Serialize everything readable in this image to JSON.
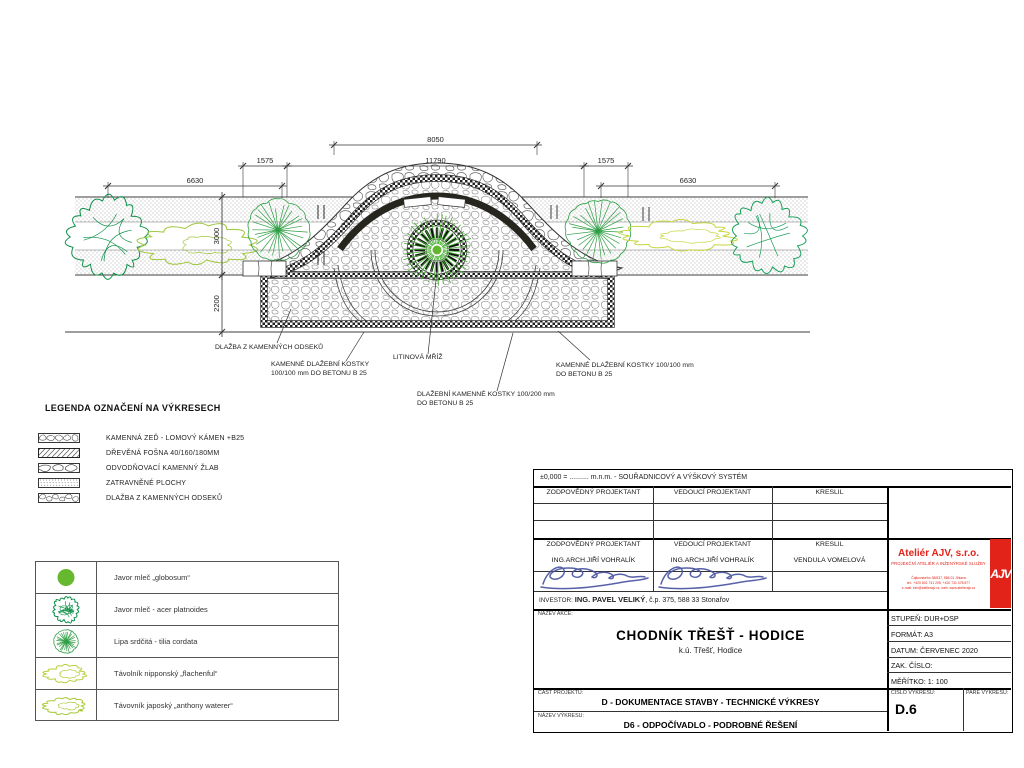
{
  "drawing": {
    "dims": {
      "d8050": "8050",
      "d11790": "11790",
      "d1575": "1575",
      "d6630": "6630",
      "d3000": "3000",
      "d2200": "2200"
    },
    "callouts": {
      "c1": {
        "l1": "DLAŽBA Z KAMENNÝCH ODSEKŮ"
      },
      "c2": {
        "l1": "KAMENNÉ DLAŽEBNÍ KOSTKY",
        "l2": "100/100 mm DO BETONU B 25"
      },
      "c3": {
        "l1": "LITINOVÁ MŘÍŽ"
      },
      "c4": {
        "l1": "DLAŽEBNÍ KAMENNÉ KOSTKY 100/200 mm",
        "l2": "DO BETONU B 25"
      },
      "c5": {
        "l1": "KAMENNÉ DLAŽEBNÍ KOSTKY 100/100 mm",
        "l2": "DO BETONU B 25"
      }
    }
  },
  "legend": {
    "title": "LEGENDA OZNAČENÍ NA VÝKRESECH",
    "items": [
      {
        "label": "KAMENNÁ ZEĎ - LOMOVÝ KÁMEN +B25",
        "swatch": "rubble-wall"
      },
      {
        "label": "DŘEVĚNÁ FOŠNA  40/160/180MM",
        "swatch": "diagonal-hatch"
      },
      {
        "label": "ODVODŇOVACÍ KAMENNÝ ŽLAB",
        "swatch": "stone-gutter"
      },
      {
        "label": "ZATRAVNĚNÉ PLOCHY",
        "swatch": "grass-stipple"
      },
      {
        "label": "DLAŽBA Z KAMENNÝCH ODSEKŮ",
        "swatch": "stone-paving"
      }
    ]
  },
  "plants": {
    "items": [
      {
        "label": "Javor mleč „globosum“",
        "symbol": "solid-green-circle"
      },
      {
        "label": "Javor mleč - acer platnoides",
        "symbol": "dark-green-crown"
      },
      {
        "label": "Lipa srdčitá - tilia cordata",
        "symbol": "radial-green-crown"
      },
      {
        "label": "Távolník nipponský „flachenful“",
        "symbol": "yellow-green-shrub"
      },
      {
        "label": "Távovník japoský „anthony waterer“",
        "symbol": "green-yellow-shrub"
      }
    ]
  },
  "title_block": {
    "datum_line": "±0,000 = ..........  m.n.m. - SOUŘADNICOVÝ A VÝŠKOVÝ SYSTÉM",
    "col_headers": {
      "h1": "ZODPOVĚDNÝ PROJEKTANT",
      "h2": "VEDOUCÍ PROJEKTANT",
      "h3": "KRESLIL"
    },
    "names": {
      "n1": "ING.ARCH.JIŘÍ VOHRALÍK",
      "n2": "ING.ARCH.JIŘÍ VOHRALÍK",
      "n3": "VENDULA VOMELOVÁ"
    },
    "investor_label": "INVESTOR:",
    "investor_value": "ING.   PAVEL VELIKÝ",
    "investor_suffix": ", č.p. 375, 588 33 Stonařov",
    "nazev_akce_label": "NÁZEV AKCE:",
    "project_title": "CHODNÍK TŘEŠŤ - HODICE",
    "project_subtitle": "k.ú. Třešť, Hodice",
    "company": {
      "name": "Ateliér AJV, s.r.o.",
      "tagline": "PROJEKČNÍ ATELIÉR A INŽENÝRSKÉ SLUŽBY",
      "line1": "Čajkovského 38/637, 586 01 Jihlava",
      "line2": "tel.: +420 602 741 205, +420 731 478 877",
      "line3": "e-mail: info@atelierajv.cz, web: www.atelierajv.cz",
      "logo": "AJV"
    },
    "fields": {
      "stupen_label": "STUPEŇ:",
      "stupen": "DUR+DSP",
      "format_label": "FORMÁT:",
      "format": "A3",
      "datum_label": "DATUM:",
      "datum": "ČERVENEC 2020",
      "zak_label": "ZAK. ČÍSLO:",
      "zak": "",
      "meritko_label": "MĚŘÍTKO:",
      "meritko": "1: 100"
    },
    "cast_label": "ČÁST PROJEKTU:",
    "cast_value": "D - DOKUMENTACE STAVBY - TECHNICKÉ VÝKRESY",
    "vykres_label": "NÁZEV VÝKRESU:",
    "vykres_value": "D6 - ODPOČÍVADLO - PODROBNÉ ŘEŠENÍ",
    "cislo_label": "ČÍSLO VÝKRESU:",
    "cislo_value": "D.6",
    "pare_label": "PARÉ VÝKRESU:"
  },
  "colors": {
    "accent_red": "#e2231a",
    "signature_blue": "#4a5fb5",
    "tree_dark_green": "#0c8f47",
    "tree_green": "#2f9e44",
    "shrub_yellow_green": "#aec93c",
    "line": "#333333"
  }
}
